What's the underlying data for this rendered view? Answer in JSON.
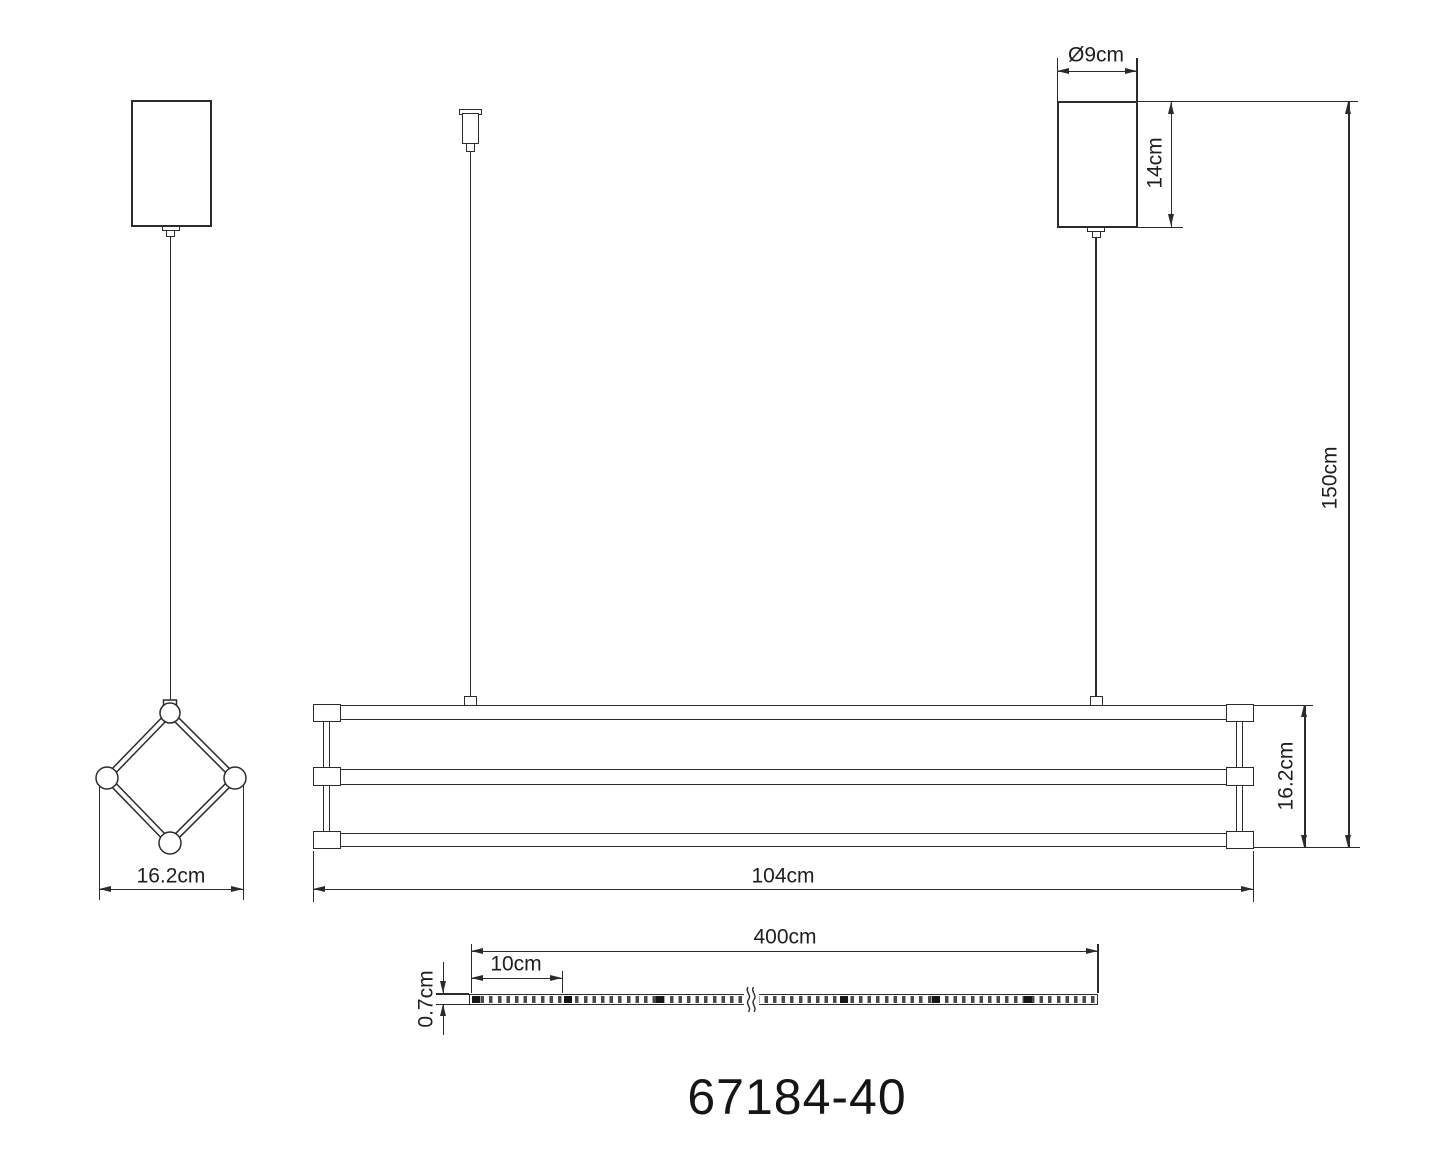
{
  "product_code": "67184-40",
  "colors": {
    "line": "#2b2b2b",
    "background": "#ffffff"
  },
  "side_view": {
    "width": "16.2cm"
  },
  "canopy": {
    "diameter": "Ø9cm",
    "height": "14cm"
  },
  "front_view": {
    "drop_height": "150cm",
    "fixture_height": "16.2cm",
    "fixture_length": "104cm"
  },
  "led_strip": {
    "length": "400cm",
    "segment": "10cm",
    "thickness": "0.7cm"
  }
}
